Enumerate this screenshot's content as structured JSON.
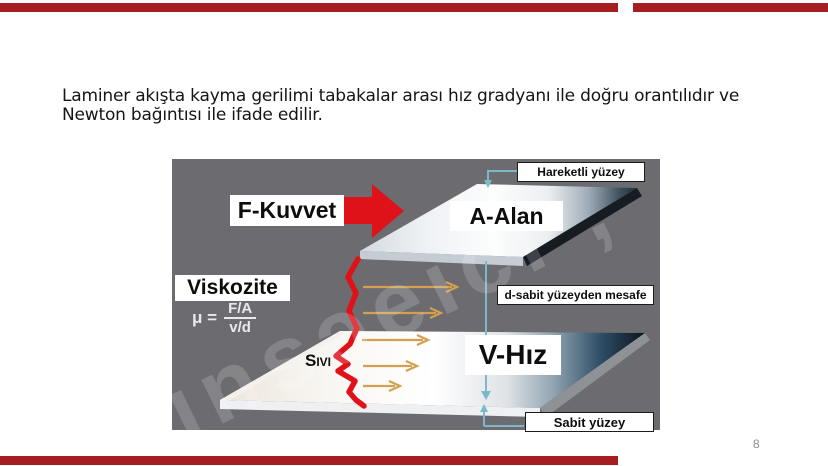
{
  "slide": {
    "body_line1": "Laminer akışta kayma gerilimi tabakalar arası hız gradyanı ile doğru orantılıdır ve",
    "body_line2": "Newton bağıntısı ile ifade edilir.",
    "page_number": "8",
    "accent_bar_color": "#a61d22"
  },
  "diagram": {
    "background_color": "#6c6c70",
    "labels": {
      "force": "F-Kuvvet",
      "area": "A-Alan",
      "moving_surface": "Hareketli yüzey",
      "viscosity": "Viskozite",
      "formula_mu": "μ =",
      "formula_numerator": "F/A",
      "formula_denominator": "v/d",
      "distance": "d-sabit yüzeyden mesafe",
      "fluid": "Sıvı",
      "velocity": "V-Hız",
      "fixed_surface": "Sabit yüzey"
    },
    "colors": {
      "force_arrow_red": "#df1119",
      "flow_arrow_tan": "#d2a050",
      "connector_teal": "#7cb9c8",
      "plate_dark_navy": "#121a22"
    },
    "watermark_glyphs": "ınsɔeıcı ,"
  }
}
